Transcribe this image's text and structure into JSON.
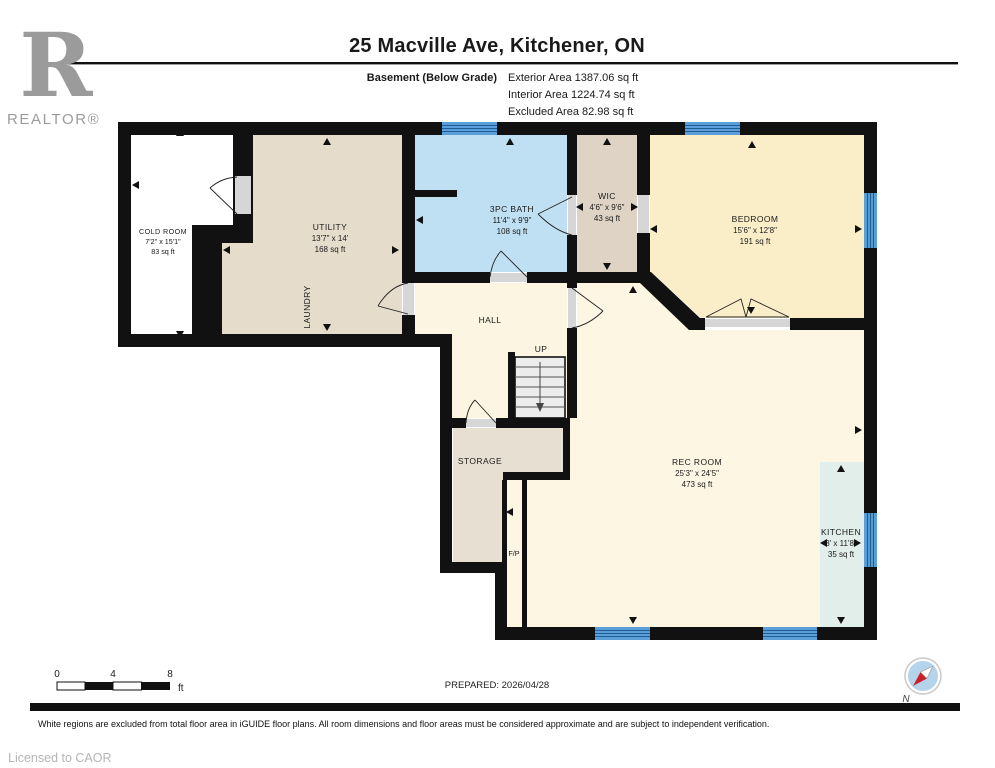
{
  "header": {
    "logo_r": "R",
    "logo_text": "REALTOR®",
    "title": "25 Macville Ave, Kitchener, ON",
    "floor_label": "Basement (Below Grade)",
    "area_lines": [
      "Exterior Area 1387.06 sq ft",
      "Interior Area 1224.74 sq ft",
      "Excluded Area 82.98 sq ft"
    ]
  },
  "rooms": {
    "cold_room": {
      "name": "COLD ROOM",
      "dims": "7'2\" x 15'1\"",
      "area": "83 sq ft"
    },
    "utility": {
      "name": "UTILITY",
      "dims": "13'7\" x 14'",
      "area": "168 sq ft"
    },
    "laundry": {
      "name": "LAUNDRY"
    },
    "bath": {
      "name": "3PC BATH",
      "dims": "11'4\" x 9'9\"",
      "area": "108 sq ft"
    },
    "wic": {
      "name": "WIC",
      "dims": "4'6\" x 9'6\"",
      "area": "43 sq ft"
    },
    "bedroom": {
      "name": "BEDROOM",
      "dims": "15'6\" x 12'8\"",
      "area": "191 sq ft"
    },
    "hall": {
      "name": "HALL"
    },
    "stairs": {
      "name": "UP"
    },
    "storage": {
      "name": "STORAGE"
    },
    "fireplace": {
      "name": "F/P"
    },
    "rec_room": {
      "name": "REC ROOM",
      "dims": "25'3\" x 24'5\"",
      "area": "473 sq ft"
    },
    "kitchen": {
      "name": "KITCHEN",
      "dims": "3' x 11'8\"",
      "area": "35 sq ft"
    }
  },
  "footer": {
    "scale_ticks": [
      "0",
      "4",
      "8"
    ],
    "scale_unit": "ft",
    "prepared": "PREPARED: 2026/04/28",
    "compass_label": "N",
    "disclaimer": "White regions are excluded from total floor area in iGUIDE floor plans. All room dimensions and floor areas must be considered approximate and are subject to independent verification.",
    "license": "Licensed to CAOR"
  },
  "colors": {
    "wall": "#111111",
    "cold_room": "#ffffff",
    "utility": "#e5dccc",
    "wic": "#ded3c4",
    "storage": "#e7dfd1",
    "bath": "#bfdff2",
    "bedroom": "#faeec8",
    "hall": "#fcf5e1",
    "rec_room": "#fdf6e3",
    "fireplace": "#fdf6e3",
    "kitchen": "#e2eee9",
    "window": "#5b9fd8",
    "window_stripe": "#1e5c96",
    "stairs": "#ececec",
    "door_sill": "#d6d6d6"
  }
}
